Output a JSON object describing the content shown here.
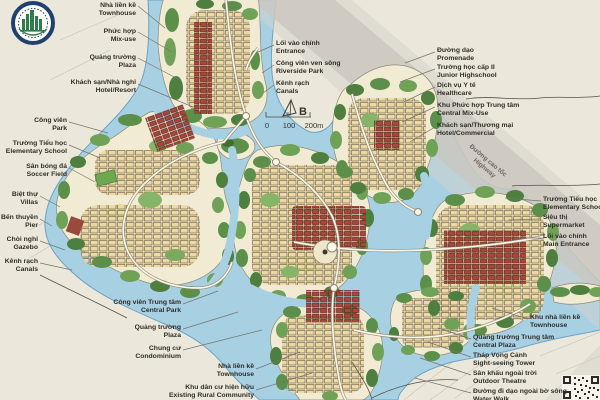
{
  "map": {
    "north_label": "B",
    "scale": {
      "t0": "0",
      "t1": "100",
      "t2": "200m"
    },
    "highway": {
      "vi": "Đường cao tốc",
      "en": "Highway"
    }
  },
  "icons": {
    "logo": "planning-institute-seal-logo",
    "north_arrow": "north-arrow-icon",
    "qr": "qr-code"
  },
  "colors": {
    "background": "#ebe7da",
    "water": "#a8d0e3",
    "water_edge": "#69a4c6",
    "land": "#f2ebd3",
    "green_dark": "#4e7f3e",
    "green": "#6fa257",
    "green_light": "#86b468",
    "building_tan": "#ecd9a6",
    "building_red": "#a6473c",
    "highway_gray": "#c9c6bd",
    "text": "#2f2e28",
    "logo_navy": "#20406f",
    "logo_green": "#2e7d4f"
  },
  "labels": [
    {
      "id": "townhouse-nw",
      "vi": "Nhà liền kề",
      "en": "Townhouse"
    },
    {
      "id": "mix-use",
      "vi": "Phức hợp",
      "en": "Mix-use"
    },
    {
      "id": "plaza-nw",
      "vi": "Quảng trường",
      "en": "Plaza"
    },
    {
      "id": "hotel-resort",
      "vi": "Khách sạn/Nhà nghỉ",
      "en": "Hotel/Resort"
    },
    {
      "id": "park",
      "vi": "Công viên",
      "en": "Park"
    },
    {
      "id": "elementary-school-w",
      "vi": "Trường Tiểu học",
      "en": "Elementary School"
    },
    {
      "id": "soccer-field",
      "vi": "Sân bóng đá",
      "en": "Soccer Field"
    },
    {
      "id": "villas",
      "vi": "Biệt thự",
      "en": "Villas"
    },
    {
      "id": "pier",
      "vi": "Bến thuyền",
      "en": "Pier"
    },
    {
      "id": "gazebo",
      "vi": "Chòi nghỉ",
      "en": "Gazebo"
    },
    {
      "id": "canals-w",
      "vi": "Kênh rạch",
      "en": "Canals"
    },
    {
      "id": "central-park",
      "vi": "Công viên Trung tâm",
      "en": "Central Park"
    },
    {
      "id": "plaza-s",
      "vi": "Quảng trường",
      "en": "Plaza"
    },
    {
      "id": "condominium",
      "vi": "Chung cư",
      "en": "Condominium"
    },
    {
      "id": "townhouse-s",
      "vi": "Nhà liền kề",
      "en": "Townhouse"
    },
    {
      "id": "existing-rural",
      "vi": "Khu dân cư hiện hữu",
      "en": "Existing Rural Community"
    },
    {
      "id": "entrance-n",
      "vi": "Lối vào chính",
      "en": "Entrance"
    },
    {
      "id": "riverside-park",
      "vi": "Công viên ven sông",
      "en": "Riverside Park"
    },
    {
      "id": "canals-n",
      "vi": "Kênh rạch",
      "en": "Canals"
    },
    {
      "id": "promenade",
      "vi": "Đường dạo",
      "en": "Promenade"
    },
    {
      "id": "junior-highschool",
      "vi": "Trường học cấp II",
      "en": "Junior Highschool"
    },
    {
      "id": "healthcare",
      "vi": "Dịch vụ Y tế",
      "en": "Healthcare"
    },
    {
      "id": "central-mix-use",
      "vi": "Khu Phức hợp Trung tâm",
      "en": "Central Mix-Use"
    },
    {
      "id": "hotel-commercial",
      "vi": "Khách sạn/Thương mại",
      "en": "Hotel/Commercial"
    },
    {
      "id": "elementary-school-e",
      "vi": "Trường Tiểu học",
      "en": "Elementary School"
    },
    {
      "id": "supermarket",
      "vi": "Siêu thị",
      "en": "Supermarket"
    },
    {
      "id": "main-entrance",
      "vi": "Lối vào chính",
      "en": "Main Entrance"
    },
    {
      "id": "townhouse-e",
      "vi": "Khu nhà liền kề",
      "en": "Townhouse"
    },
    {
      "id": "central-plaza",
      "vi": "Quảng trường Trung tâm",
      "en": "Central Plaza"
    },
    {
      "id": "sightseeing-tower",
      "vi": "Tháp Vọng Cảnh",
      "en": "Sight-seeing Tower"
    },
    {
      "id": "outdoor-theatre",
      "vi": "Sân khấu ngoài trời",
      "en": "Outdoor Theatre"
    },
    {
      "id": "water-walk",
      "vi": "Đường đi dạo ngoài bờ sông",
      "en": "Water Walk"
    }
  ]
}
